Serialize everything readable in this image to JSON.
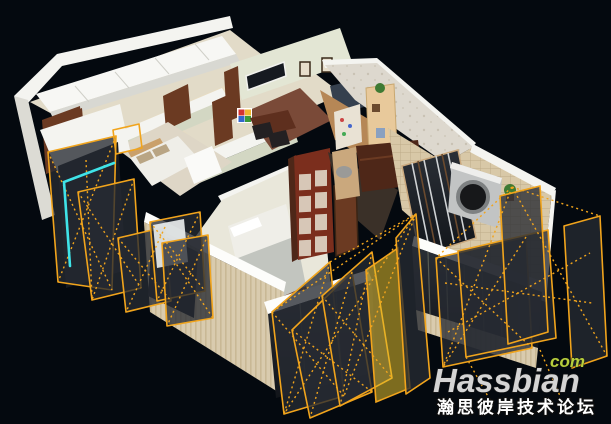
{
  "watermark": {
    "tld": "com",
    "brand": "Hassbian",
    "tagline": "瀚思彼岸技术论坛"
  },
  "colors": {
    "background": "#04090f",
    "wireframe-yellow": "#f1a41c",
    "selection-cyan": "#3fe3e8",
    "wall-top-white": "#f4f4f0",
    "interior-wall-sage": "#e3e6d4",
    "facade-beige": "#d9cbae",
    "dark-glass": "#161a20",
    "door-wood": "#6b3a22",
    "bookcase-red": "#7b2e1d",
    "watermark-gray": "#d4d4d4",
    "watermark-green": "#b6cd3d"
  },
  "scene": {
    "type": "3d-apartment-floorplan-render",
    "elements": [
      "kitchen-cabinets",
      "pantry-cabinet",
      "bathroom-floor",
      "hallway",
      "interior-doors",
      "wall-window-strip",
      "picture-frames",
      "wall-art-colorful",
      "dining-table",
      "dining-chairs",
      "denim-accent-wall",
      "bedroom-left-bed",
      "white-dresser",
      "bedroom-center-bed",
      "glass-bookcase",
      "study-wallpaper-wall",
      "corner-shelf",
      "study-sofa",
      "study-desk",
      "trinket-shelf",
      "balcony-tile-walls",
      "sloped-glass-roof",
      "washing-machine",
      "potted-plant",
      "facade-windows",
      "window-ledges",
      "window-frustum-left",
      "window-frustum-center",
      "window-frustum-right",
      "cyan-selection-highlight"
    ]
  }
}
